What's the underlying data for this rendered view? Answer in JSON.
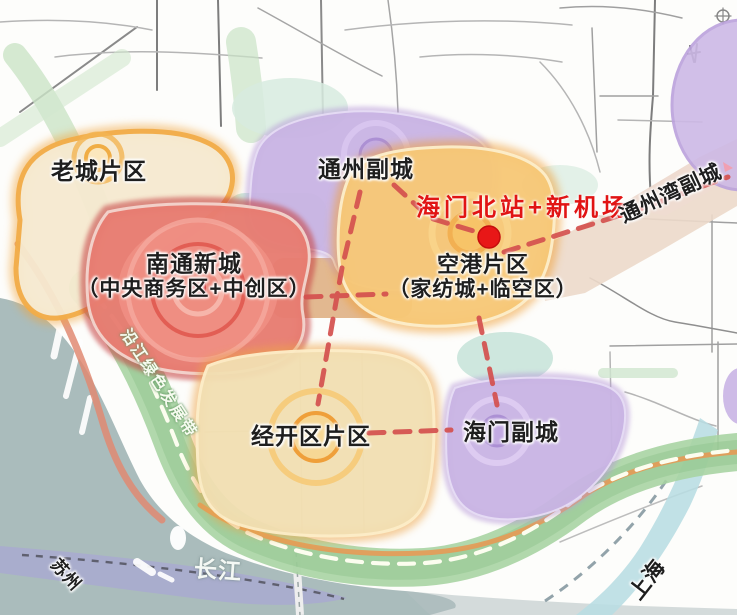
{
  "map": {
    "highlight": {
      "label": "海门北站+新机场",
      "color": "#e11414",
      "marker": "red-dot"
    },
    "regions": [
      {
        "id": "old-city",
        "label": "老城片区",
        "border_color": "#f0a43c",
        "fill_color": "#f6ead0"
      },
      {
        "id": "nantong-new-city",
        "label": "南通新城",
        "sublabel": "（中央商务区+中创区）",
        "border_color": "#c84848",
        "fill_color": "#e87d72"
      },
      {
        "id": "tongzhou-sub-city",
        "label": "通州副城",
        "border_color": "#b79ad8",
        "fill_color": "#c9b4e4"
      },
      {
        "id": "airport-district",
        "label": "空港片区",
        "sublabel": "（家纺城+临空区）",
        "border_color": "#f0a13a",
        "fill_color": "#f7c877"
      },
      {
        "id": "jingkai-district",
        "label": "经开区片区",
        "border_color": "#eda449",
        "fill_color": "#f2dfb2"
      },
      {
        "id": "haimen-sub-city",
        "label": "海门副城",
        "border_color": "#b79ad8",
        "fill_color": "#c9b4e4"
      },
      {
        "id": "tongzhouwan-sub-city",
        "label": "通州湾副城",
        "fill_color": "#ecd9ca"
      }
    ],
    "corridors": {
      "green_belt_label": "沿江绿色发展带",
      "green_belt_color": "#a6d3a0",
      "link_line_color": "#d4504e"
    },
    "geography": {
      "river": "长江",
      "west_city": "苏州",
      "southeast_city": "上海"
    }
  }
}
